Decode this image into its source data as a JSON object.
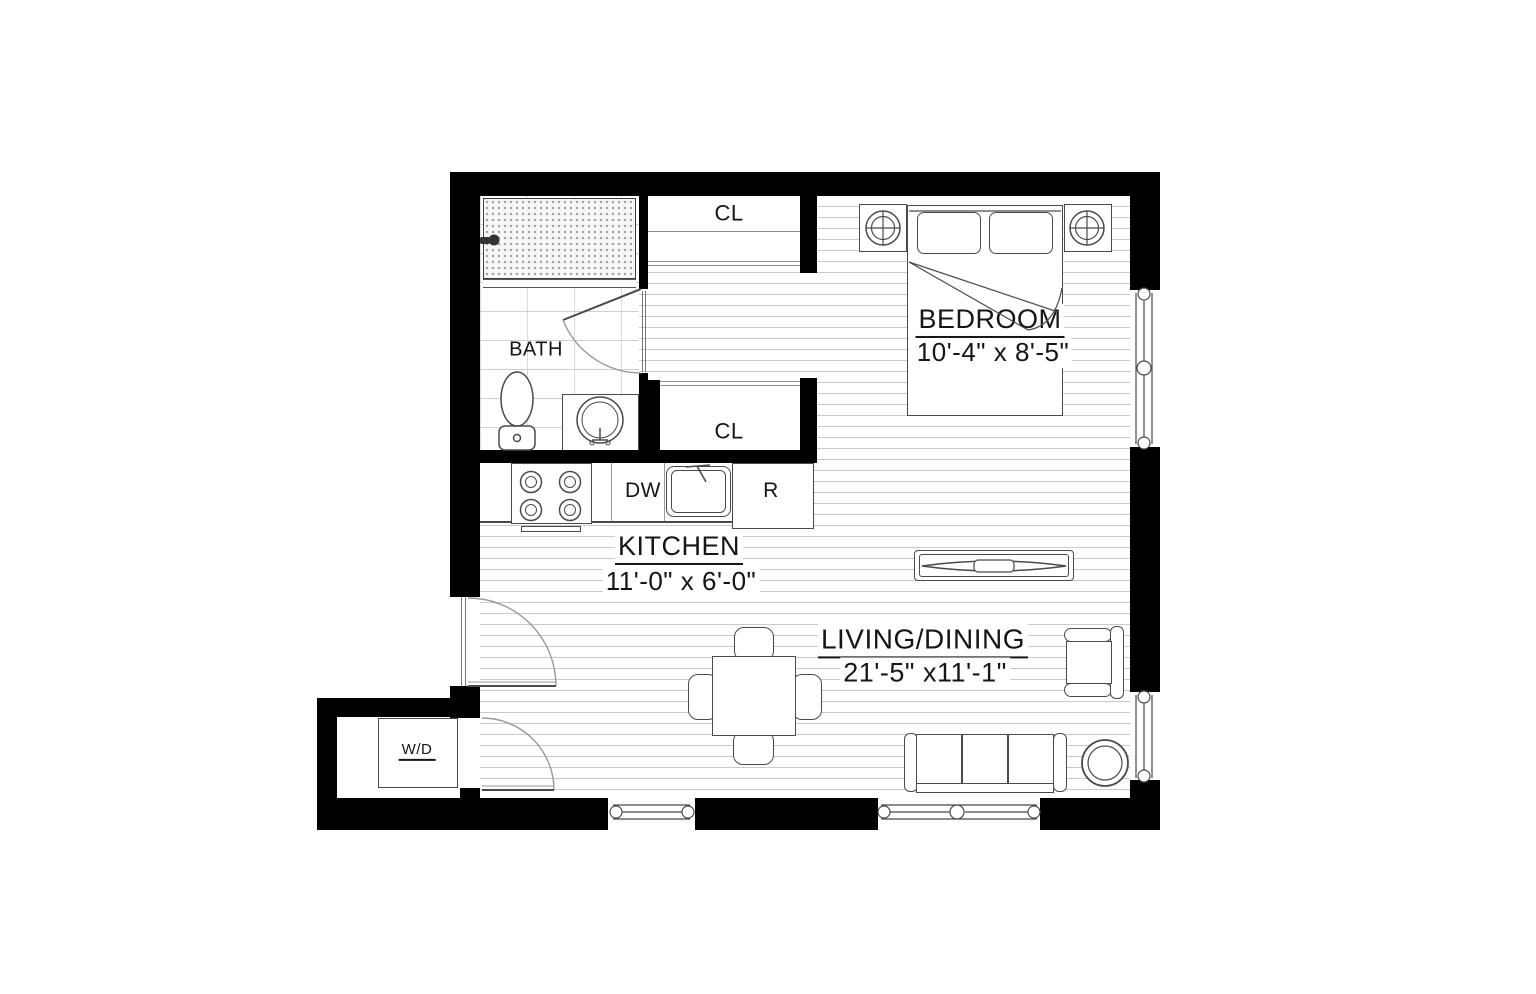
{
  "plan": {
    "title": "studio-apartment-floor-plan",
    "rooms": {
      "bath": {
        "label": "BATH"
      },
      "closet_top": {
        "label": "CL"
      },
      "closet_bottom": {
        "label": "CL"
      },
      "bedroom": {
        "label": "BEDROOM",
        "dimensions": "10'-4\" x 8'-5\""
      },
      "kitchen": {
        "label": "KITCHEN",
        "dimensions": "11'-0\" x 6'-0\""
      },
      "living_dining": {
        "label": "LIVING/DINING",
        "dimensions": "21'-5\" x11'-1\""
      }
    },
    "appliances": {
      "dishwasher": "DW",
      "refrigerator": "R",
      "washer_dryer": "W/D"
    },
    "icons": {
      "shower-head-icon": "wall-mounted circle+stem",
      "toilet-icon": "oval bowl + tank",
      "sink-icon": "double circle + faucet",
      "stove-burner-icon": "double circle x4",
      "table-lamp-icon": "circle with cross",
      "window-icon": "triple line with round mullions",
      "door-swing-icon": "quarter-circle arc"
    },
    "colors": {
      "wall": "#000000",
      "floor_line": "#c9c9c9",
      "furniture_line": "#4a4a4a",
      "door_arc": "#999999"
    }
  }
}
